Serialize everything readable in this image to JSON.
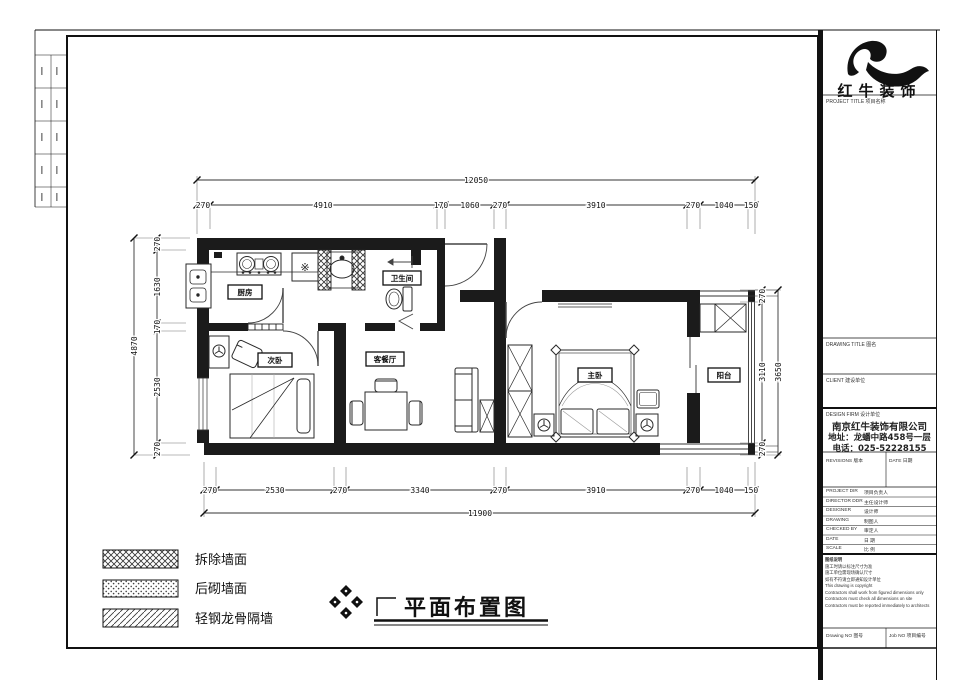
{
  "plan": {
    "title": "平面布置图",
    "rooms": {
      "kitchen": "厨房",
      "bathroom": "卫生间",
      "bedroom2": "次卧",
      "living": "客餐厅",
      "master": "主卧",
      "balcony": "阳台"
    },
    "appliance_glyph": "※",
    "dims": {
      "top_overall": "12050",
      "top": [
        "270",
        "4910",
        "170",
        "1060",
        "270",
        "3910",
        "270",
        "1040",
        "150"
      ],
      "bottom": [
        "270",
        "2530",
        "270",
        "3340",
        "270",
        "3910",
        "270",
        "1040",
        "150"
      ],
      "bottom_overall": "11900",
      "left_overall": "4870",
      "left": [
        "270",
        "1630",
        "170",
        "2530",
        "270"
      ],
      "right": [
        "270",
        "3110",
        "270"
      ],
      "right_overall": "3650"
    }
  },
  "legend": {
    "items": [
      {
        "label": "拆除墙面"
      },
      {
        "label": "后砌墙面"
      },
      {
        "label": "轻钢龙骨隔墙"
      }
    ]
  },
  "title_block": {
    "logo_text": "红牛装饰",
    "project_title_label": "PROJECT TITLE  项目名称",
    "drawing_title_label": "DRAWING TITLE  图名",
    "client_label": "CLIENT  建设单位",
    "design_firm_label": "DESIGN FIRM  设计单位",
    "company_name": "南京红牛装饰有限公司",
    "company_address": "地址：龙蟠中路458号一层",
    "company_phone": "电话：025-52228155",
    "revisions_label": "REVISIONS  版本",
    "date_col_label": "DATE  日期",
    "fields": [
      {
        "label": "PROJECT DIR",
        "value": "项目负责人"
      },
      {
        "label": "DIRECTOR DDR",
        "value": "主任设计师"
      },
      {
        "label": "DESIGNER",
        "value": "设计师"
      },
      {
        "label": "DRAWING",
        "value": "制图人"
      },
      {
        "label": "CHECKED BY",
        "value": "审定人"
      },
      {
        "label": "DATE",
        "value": "日  期"
      },
      {
        "label": "SCALE",
        "value": "比  例"
      }
    ],
    "notes": [
      "图纸说明",
      "施工时请以标注尺寸为准",
      "施工单位需现场确认尺寸",
      "如有不符请立即通知设计单位",
      "This drawing is copyright",
      "Contractors shall work from figured dimensions only",
      "Contractors must check all dimensions on site",
      "Contractors must be reported immediately to architects"
    ],
    "drawing_no_label": "Drawing NO  图号",
    "job_no_label": "Job NO  项目编号"
  }
}
